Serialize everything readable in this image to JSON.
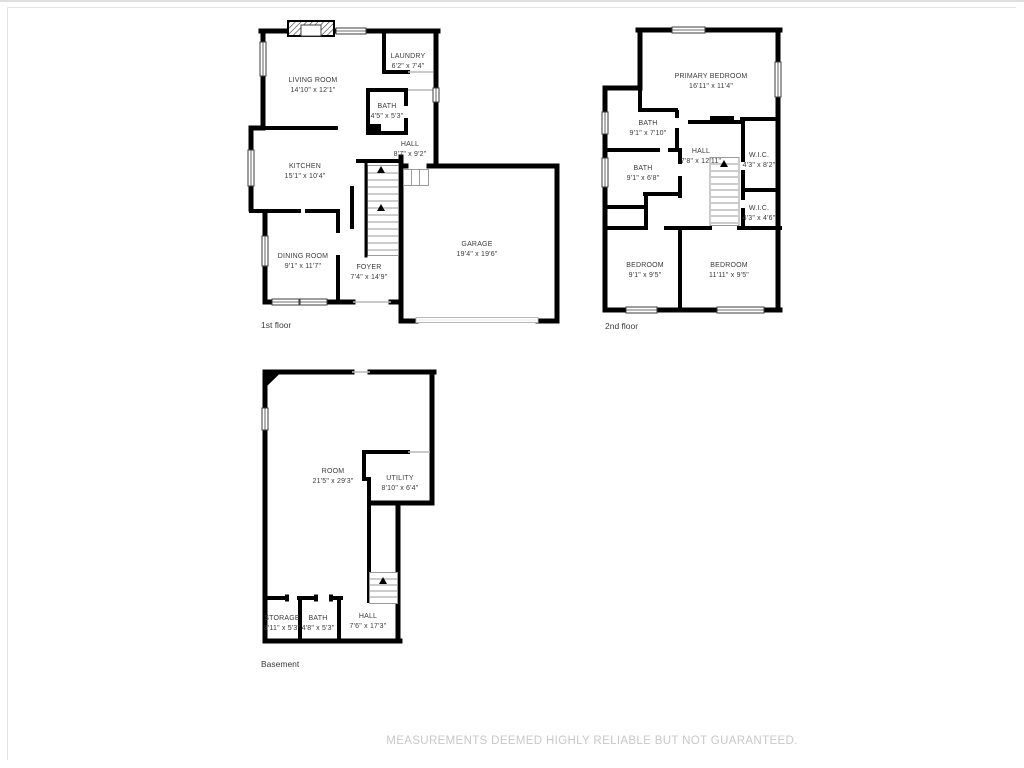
{
  "disclaimer": "MEASUREMENTS DEEMED HIGHLY RELIABLE BUT NOT GUARANTEED.",
  "colors": {
    "background": "#ffffff",
    "wall_color": "#000000",
    "stair_color": "#9a9a9a",
    "window_color": "#3d3d3d",
    "door_color": "#b9b9b9",
    "label_color": "#3b3b3b",
    "caption_color": "#3b3b3b",
    "disclaimer_color": "#c8c8c8",
    "frame_color": "#e3e3e3"
  },
  "floors": {
    "first": {
      "label": "1st floor",
      "rooms": [
        {
          "name": "LIVING ROOM",
          "dims": "14'10\" x 12'1\""
        },
        {
          "name": "LAUNDRY",
          "dims": "6'2\" x 7'4\""
        },
        {
          "name": "BATH",
          "dims": "4'5\" x 5'3\""
        },
        {
          "name": "HALL",
          "dims": "8'7\" x 9'2\""
        },
        {
          "name": "KITCHEN",
          "dims": "15'1\" x 10'4\""
        },
        {
          "name": "DINING ROOM",
          "dims": "9'1\" x 11'7\""
        },
        {
          "name": "FOYER",
          "dims": "7'4\" x 14'9\""
        },
        {
          "name": "GARAGE",
          "dims": "19'4\" x 19'6\""
        }
      ]
    },
    "second": {
      "label": "2nd floor",
      "rooms": [
        {
          "name": "PRIMARY BEDROOM",
          "dims": "16'11\" x 11'4\""
        },
        {
          "name": "BATH",
          "dims": "9'1\" x 7'10\""
        },
        {
          "name": "HALL",
          "dims": "7'8\" x 12'11\""
        },
        {
          "name": "W.I.C.",
          "dims": "4'3\" x 8'2\""
        },
        {
          "name": "BATH",
          "dims": "9'1\" x 6'8\""
        },
        {
          "name": "W.I.C.",
          "dims": "4'3\" x 4'6\""
        },
        {
          "name": "BEDROOM",
          "dims": "9'1\" x 9'5\""
        },
        {
          "name": "BEDROOM",
          "dims": "11'11\" x 9'5\""
        }
      ]
    },
    "basement": {
      "label": "Basement",
      "rooms": [
        {
          "name": "ROOM",
          "dims": "21'5\" x 29'3\""
        },
        {
          "name": "UTILITY",
          "dims": "8'10\" x 6'4\""
        },
        {
          "name": "STORAGE",
          "dims": "3'11\" x 5'3\""
        },
        {
          "name": "BATH",
          "dims": "4'8\" x 5'3\""
        },
        {
          "name": "HALL",
          "dims": "7'6\" x 17'3\""
        }
      ]
    }
  }
}
